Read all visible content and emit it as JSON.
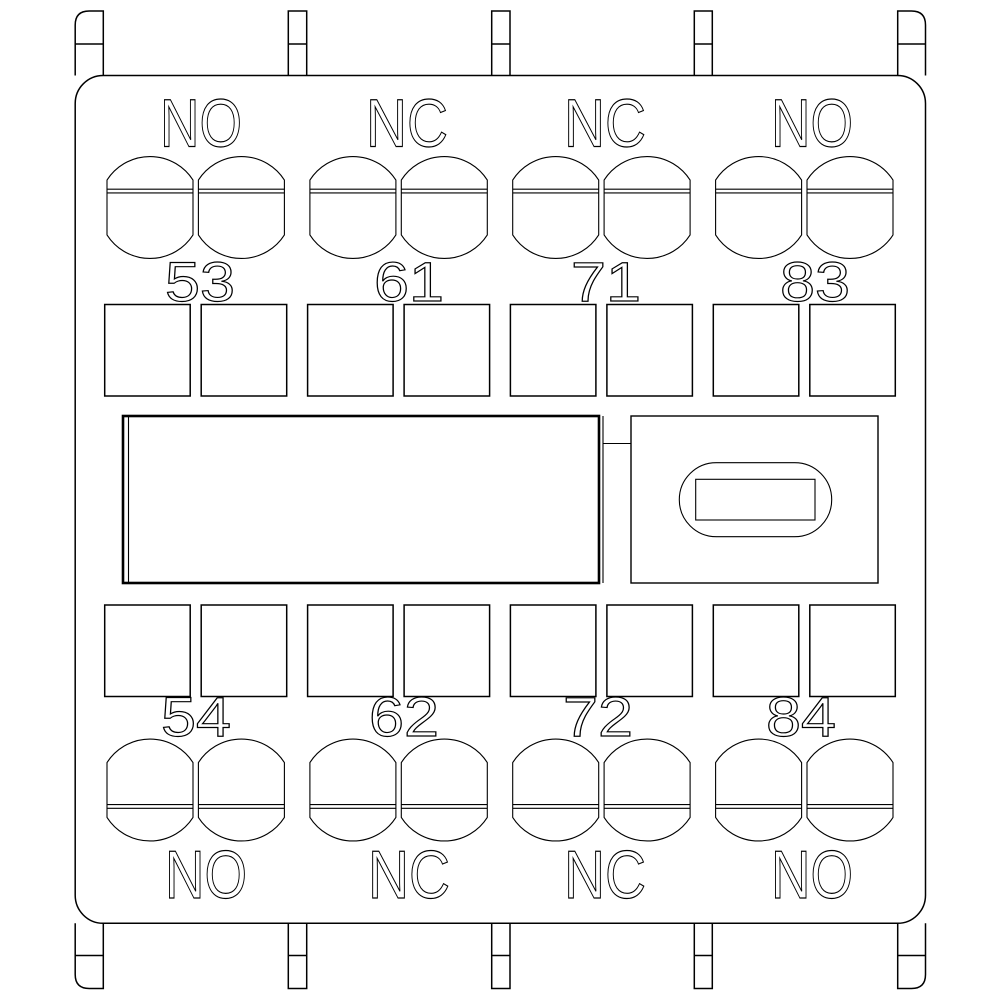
{
  "colors": {
    "line": "#000000",
    "background": "#ffffff"
  },
  "diagram": {
    "groups": [
      {
        "top_label": "NO",
        "top_terminal": "53",
        "bottom_terminal": "54",
        "bottom_label": "NO"
      },
      {
        "top_label": "NC",
        "top_terminal": "61",
        "bottom_terminal": "62",
        "bottom_label": "NC"
      },
      {
        "top_label": "NC",
        "top_terminal": "71",
        "bottom_terminal": "72",
        "bottom_label": "NC"
      },
      {
        "top_label": "NO",
        "top_terminal": "83",
        "bottom_terminal": "84",
        "bottom_label": "NO"
      }
    ]
  }
}
